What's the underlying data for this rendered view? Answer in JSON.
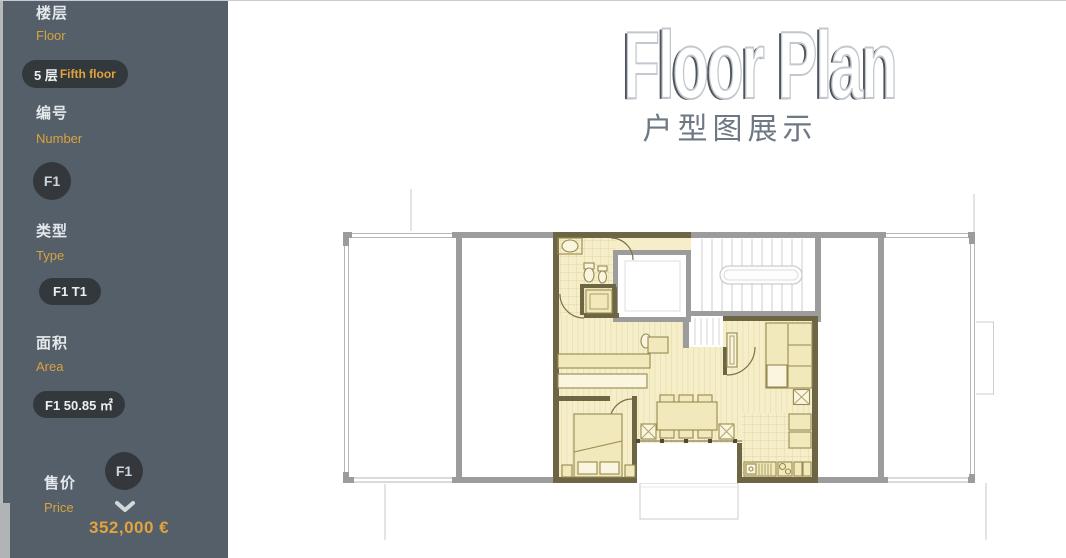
{
  "header": {
    "title": "Floor Plan",
    "subtitle": "户型图展示"
  },
  "sidebar": {
    "floor": {
      "zh": "楼层",
      "en": "Floor",
      "badge_zh": "5 层",
      "badge_en": "Fifth floor"
    },
    "number": {
      "zh": "编号",
      "en": "Number",
      "badge": "F1"
    },
    "type": {
      "zh": "类型",
      "en": "Type",
      "badge": "F1 T1"
    },
    "area": {
      "zh": "面积",
      "en": "Area",
      "badge": "F1 50.85 ㎡"
    },
    "price": {
      "zh": "售价",
      "en": "Price",
      "badge": "F1",
      "value": "352,000 €"
    }
  },
  "icons": {
    "price_expand": "chevron-down-icon"
  },
  "floorplan": {
    "highlighted_unit": "F1"
  },
  "colors": {
    "sidebar_bg": "#545f69",
    "badge_bg": "#33383c",
    "accent_orange": "#dfa23d",
    "price_orange": "#e2a33c",
    "unit_fill": "#f5eec9",
    "unit_wall": "#6e6544",
    "common_wall": "#9c9c9c"
  }
}
